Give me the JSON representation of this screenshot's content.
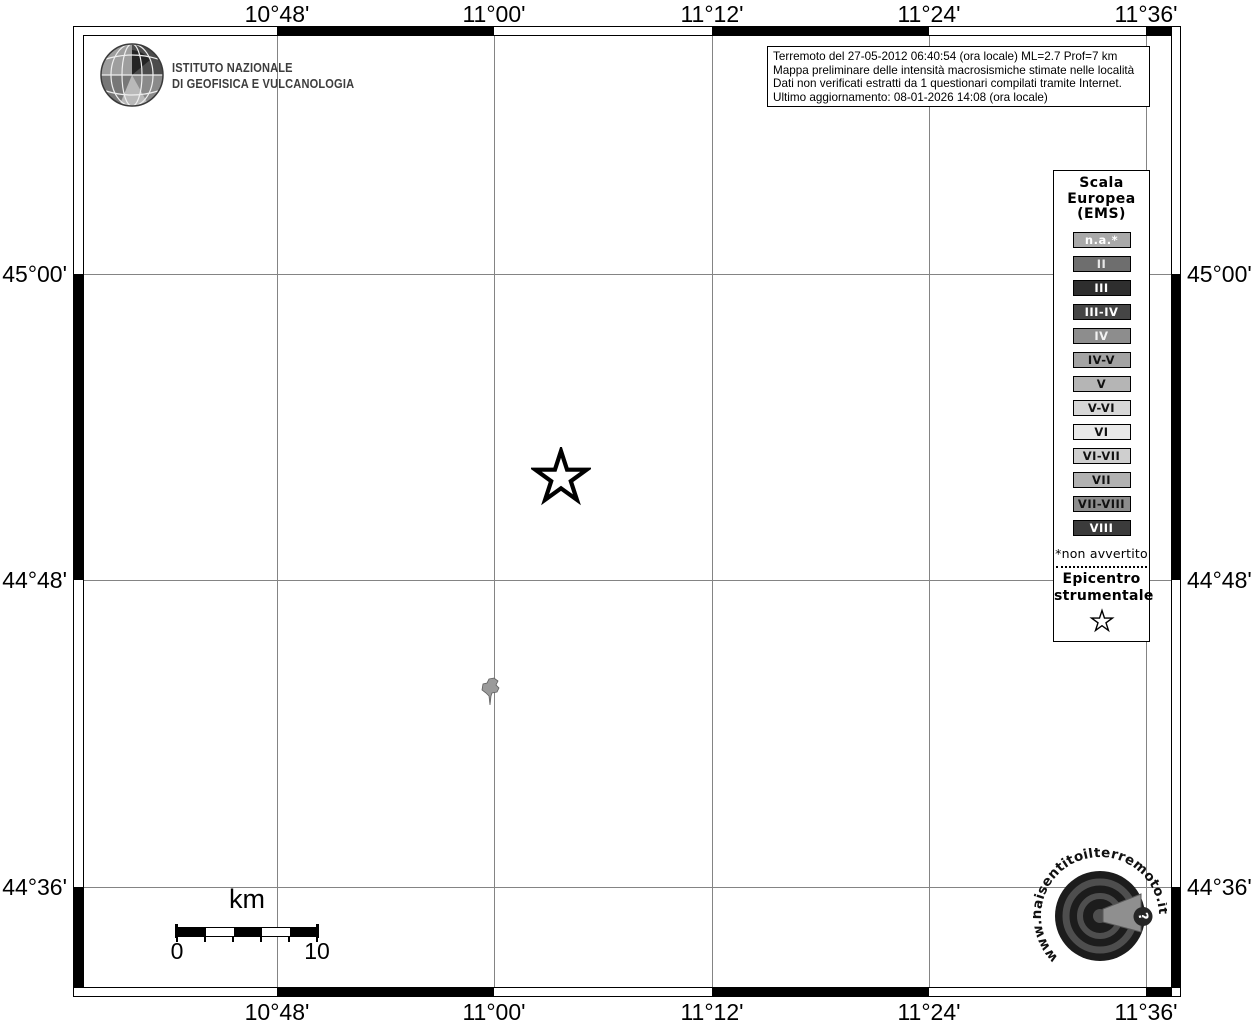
{
  "branding": {
    "ingv_line1": "ISTITUTO NAZIONALE",
    "ingv_line2": "DI GEOFISICA E VULCANOLOGIA"
  },
  "info_box": {
    "line1": "Terremoto del 27-05-2012 06:40:54 (ora locale) ML=2.7 Prof=7 km",
    "line2": "Mappa preliminare delle intensità macrosismiche stimate nelle località",
    "line3": "Dati non verificati estratti da 1 questionari compilati tramite Internet.",
    "line4": "Ultimo aggiornamento: 08-01-2026 14:08 (ora locale)"
  },
  "axis": {
    "lon_labels": [
      "10°48'",
      "11°00'",
      "11°12'",
      "11°24'",
      "11°36'"
    ],
    "lat_labels": [
      "45°00'",
      "44°48'",
      "44°36'"
    ]
  },
  "legend": {
    "title_lines": [
      "Scala",
      "Europea",
      "(EMS)"
    ],
    "items": [
      {
        "label": "n.a.*",
        "fill": "#a9a9a9",
        "text": "#ffffff"
      },
      {
        "label": "II",
        "fill": "#6e6e6e",
        "text": "#e8e8e8"
      },
      {
        "label": "III",
        "fill": "#2e2e2e",
        "text": "#ffffff"
      },
      {
        "label": "III-IV",
        "fill": "#454545",
        "text": "#ffffff"
      },
      {
        "label": "IV",
        "fill": "#8d8d8d",
        "text": "#f2f2f2"
      },
      {
        "label": "IV-V",
        "fill": "#a3a3a3",
        "text": "#111111"
      },
      {
        "label": "V",
        "fill": "#b5b5b5",
        "text": "#111111"
      },
      {
        "label": "V-VI",
        "fill": "#d7d7d7",
        "text": "#111111"
      },
      {
        "label": "VI",
        "fill": "#e9e9e9",
        "text": "#111111"
      },
      {
        "label": "VI-VII",
        "fill": "#cfcfcf",
        "text": "#111111"
      },
      {
        "label": "VII",
        "fill": "#b1b1b1",
        "text": "#111111"
      },
      {
        "label": "VII-VIII",
        "fill": "#8c8c8c",
        "text": "#111111"
      },
      {
        "label": "VIII",
        "fill": "#3b3b3b",
        "text": "#ffffff"
      }
    ],
    "footnote": "*non avvertito",
    "epicenter_line1": "Epicentro",
    "epicenter_line2": "strumentale"
  },
  "scale_bar": {
    "unit": "km",
    "start_label": "0",
    "end_label": "10"
  },
  "markers": {
    "epicenter_symbol": "star-outline",
    "locality_symbol": "municipality-shape"
  },
  "hsit": {
    "url": "www.haisentitoilterremoto.it",
    "badge": "?"
  }
}
